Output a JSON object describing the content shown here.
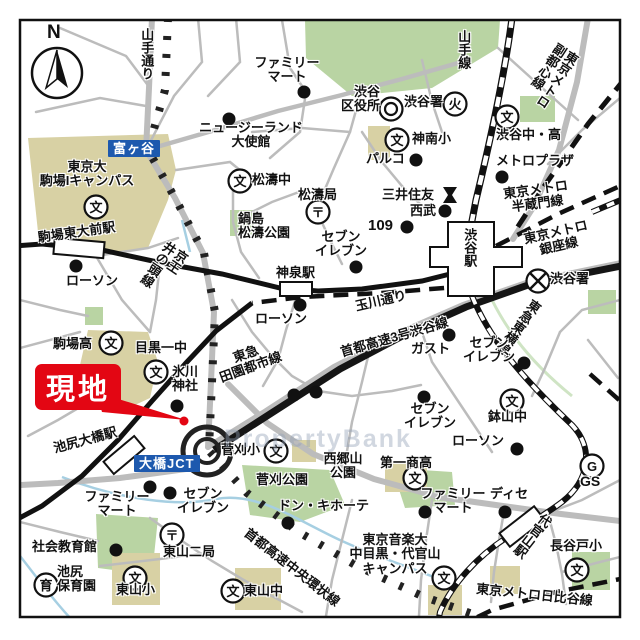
{
  "map": {
    "watermark": "PropertyBank",
    "compass_label": "N",
    "callout": {
      "text": "現地",
      "color": "#e30613"
    },
    "colors": {
      "road": "#bcbcbc",
      "park": "#b9d4a3",
      "campus": "#d8d1a4",
      "water": "#a6cfe2",
      "rail": "#1a1a1a",
      "sign_blue": "#1d59ae",
      "accent_red": "#e30613"
    },
    "signs": [
      {
        "name": "tomigaya-sign",
        "text": "富ヶ谷",
        "x": 108,
        "y": 140
      },
      {
        "name": "ohashi-jct-sign",
        "text": "大橋JCT",
        "x": 134,
        "y": 455
      }
    ],
    "labels": [
      {
        "name": "yamate-dori-label",
        "text": "山手通り",
        "x": 139,
        "y": 28,
        "vert": true
      },
      {
        "name": "yamanote-line-label",
        "text": "山手線",
        "x": 456,
        "y": 30,
        "vert": true
      },
      {
        "name": "fukutoshin-line-label",
        "text": "東京メトロ\n副都心線",
        "x": 556,
        "y": 40,
        "vert": true,
        "rot": 33
      },
      {
        "name": "familymart-top-label",
        "text": "ファミリー\nマート",
        "x": 250,
        "y": 56,
        "w": 74,
        "ctr": true
      },
      {
        "name": "nz-embassy-label",
        "text": "ニュージーランド\n大使館",
        "x": 194,
        "y": 121,
        "w": 114,
        "ctr": true
      },
      {
        "name": "shibuya-ward-office-label",
        "text": "渋谷\n区役所",
        "x": 332,
        "y": 85,
        "w": 48,
        "rgt": true
      },
      {
        "name": "shibuya-fire-station-label",
        "text": "渋谷署",
        "x": 404,
        "y": 95
      },
      {
        "name": "jinnan-elementary-label",
        "text": "神南小",
        "x": 412,
        "y": 132
      },
      {
        "name": "shibuya-jhs-hs-label",
        "text": "渋谷中・高",
        "x": 496,
        "y": 128
      },
      {
        "name": "metro-plaza-label",
        "text": "メトロプラザ",
        "x": 496,
        "y": 154
      },
      {
        "name": "parco-label",
        "text": "パルコ",
        "x": 366,
        "y": 152
      },
      {
        "name": "mitsui-sumitomo-label",
        "text": "三井住友",
        "x": 382,
        "y": 188
      },
      {
        "name": "seibu-label",
        "text": "西武",
        "x": 410,
        "y": 204
      },
      {
        "name": "shibuya-109-label",
        "text": "109",
        "x": 368,
        "y": 218,
        "size": 15
      },
      {
        "name": "shoto-jhs-label",
        "text": "松濤中",
        "x": 252,
        "y": 173
      },
      {
        "name": "shoto-post-label",
        "text": "松濤局",
        "x": 298,
        "y": 188
      },
      {
        "name": "nabeshima-shoto-park-label",
        "text": "鍋島\n松濤公園",
        "x": 238,
        "y": 212,
        "w": 58
      },
      {
        "name": "todai-komaba-campus-label",
        "text": "東京大\n駒場Iキャンパス",
        "x": 34,
        "y": 160,
        "w": 106,
        "ctr": true
      },
      {
        "name": "komaba-todaimae-station-label",
        "text": "駒場東大前駅",
        "x": 37,
        "y": 231,
        "rot": -8
      },
      {
        "name": "keio-inokashira-line-label",
        "text": "京王\n井の頭線",
        "x": 166,
        "y": 238,
        "vert": true,
        "rot": 34
      },
      {
        "name": "lawson-west-label",
        "text": "ローソン",
        "x": 66,
        "y": 274
      },
      {
        "name": "shinsen-station-label",
        "text": "神泉駅",
        "x": 276,
        "y": 266
      },
      {
        "name": "seven-eleven-center-label",
        "text": "セブン\nイレブン",
        "x": 312,
        "y": 230,
        "w": 58,
        "ctr": true
      },
      {
        "name": "lawson-center-label",
        "text": "ローソン",
        "x": 255,
        "y": 312
      },
      {
        "name": "tamagawa-dori-label",
        "text": "玉川通り",
        "x": 354,
        "y": 300,
        "rot": -13
      },
      {
        "name": "shuto-no3-shibuya-line-label",
        "text": "首都高速3号渋谷線",
        "x": 339,
        "y": 346,
        "rot": -16
      },
      {
        "name": "denentoshi-line-label",
        "text": "東急\n田園都市線",
        "x": 204,
        "y": 362,
        "w": 84,
        "ctr": true,
        "rot": -20
      },
      {
        "name": "shibuya-station-label",
        "text": "渋谷駅",
        "x": 462,
        "y": 228,
        "vert": true
      },
      {
        "name": "hanzomon-line-label",
        "text": "東京メトロ\n半蔵門線",
        "x": 499,
        "y": 188,
        "w": 72,
        "ctr": true,
        "rot": -8
      },
      {
        "name": "ginza-line-label",
        "text": "東京メトロ\n銀座線",
        "x": 522,
        "y": 233,
        "w": 66,
        "ctr": true,
        "rot": -13
      },
      {
        "name": "shibuya-police-label",
        "text": "渋谷署",
        "x": 550,
        "y": 272
      },
      {
        "name": "toyoko-line-label",
        "text": "東急東横線",
        "x": 531,
        "y": 296,
        "vert": true,
        "rot": 36
      },
      {
        "name": "gusto-label",
        "text": "ガスト",
        "x": 411,
        "y": 342
      },
      {
        "name": "seven-eleven-east-label",
        "text": "セブン\nイレブン",
        "x": 460,
        "y": 336,
        "w": 58,
        "ctr": true
      },
      {
        "name": "seven-eleven-south-label",
        "text": "セブン\nイレブン",
        "x": 401,
        "y": 402,
        "w": 58,
        "ctr": true
      },
      {
        "name": "hachiyama-jhs-label",
        "text": "鉢山中",
        "x": 488,
        "y": 410
      },
      {
        "name": "lawson-south-label",
        "text": "ローソン",
        "x": 452,
        "y": 434
      },
      {
        "name": "komaba-high-label",
        "text": "駒場高",
        "x": 53,
        "y": 337
      },
      {
        "name": "meguro-1-jhs-label",
        "text": "目黒一中",
        "x": 135,
        "y": 341
      },
      {
        "name": "hikawa-shrine-label",
        "text": "氷川\n神社",
        "x": 164,
        "y": 365,
        "w": 42,
        "ctr": true
      },
      {
        "name": "ikejiri-ohashi-station-label",
        "text": "池尻大橋駅",
        "x": 52,
        "y": 442,
        "rot": -15
      },
      {
        "name": "sugekari-elementary-label",
        "text": "菅刈小",
        "x": 221,
        "y": 443
      },
      {
        "name": "sugekari-park-label",
        "text": "菅刈公園",
        "x": 256,
        "y": 473
      },
      {
        "name": "saigoyama-park-label",
        "text": "西郷山\n公園",
        "x": 316,
        "y": 452,
        "w": 54,
        "ctr": true
      },
      {
        "name": "daiichi-shoko-label",
        "text": "第一商高",
        "x": 380,
        "y": 456
      },
      {
        "name": "familymart-southwest-label",
        "text": "ファミリー\nマート",
        "x": 78,
        "y": 490,
        "w": 78,
        "ctr": true
      },
      {
        "name": "seven-eleven-jct-label",
        "text": "セブン\nイレブン",
        "x": 174,
        "y": 487,
        "w": 58,
        "ctr": true
      },
      {
        "name": "shakai-kyoikukan-label",
        "text": "社会教育館",
        "x": 32,
        "y": 540
      },
      {
        "name": "higashiyama-2-post-label",
        "text": "東山二局",
        "x": 163,
        "y": 545
      },
      {
        "name": "ikejiri-hoikuen-label",
        "text": "池尻\n保育園",
        "x": 57,
        "y": 565
      },
      {
        "name": "higashiyama-elementary-label",
        "text": "東山小",
        "x": 116,
        "y": 583
      },
      {
        "name": "higashiyama-jhs-label",
        "text": "東山中",
        "x": 244,
        "y": 584
      },
      {
        "name": "don-quijote-label",
        "text": "ドン・キホーテ",
        "x": 278,
        "y": 499
      },
      {
        "name": "chuo-kanjo-line-label",
        "text": "首都高速中央環状線",
        "x": 250,
        "y": 526,
        "rot": 38
      },
      {
        "name": "tokyo-ongaku-univ-label",
        "text": "東京音楽大\n中目黒・代官山\nキャンパス",
        "x": 346,
        "y": 533,
        "w": 98,
        "ctr": true
      },
      {
        "name": "familymart-southeast-label",
        "text": "ファミリー\nマート",
        "x": 416,
        "y": 487,
        "w": 74,
        "ctr": true
      },
      {
        "name": "dise-label",
        "text": "ディセ",
        "x": 490,
        "y": 487
      },
      {
        "name": "daikanyama-station-label",
        "text": "代官山駅",
        "x": 542,
        "y": 510,
        "vert": true,
        "rot": 38
      },
      {
        "name": "hasedo-elementary-label",
        "text": "長谷戸小",
        "x": 550,
        "y": 539
      },
      {
        "name": "hibiya-line-label",
        "text": "東京メトロ日比谷線",
        "x": 477,
        "y": 582,
        "rot": 6
      },
      {
        "name": "gas-station-label",
        "text": "GS",
        "x": 580,
        "y": 474,
        "size": 14
      }
    ],
    "symbols": [
      {
        "name": "ward-office-symbol",
        "kind": "gov",
        "x": 391,
        "y": 109,
        "char": ""
      },
      {
        "name": "fire-station-symbol",
        "kind": "char",
        "x": 455,
        "y": 104,
        "char": "火"
      },
      {
        "name": "police-station-symbol",
        "kind": "police",
        "x": 538,
        "y": 281,
        "char": ""
      },
      {
        "name": "post-office-shoto-symbol",
        "kind": "char",
        "x": 318,
        "y": 212,
        "char": "〒"
      },
      {
        "name": "post-office-higashiyama-symbol",
        "kind": "char",
        "x": 172,
        "y": 535,
        "char": "〒"
      },
      {
        "name": "bank-symbol",
        "kind": "bank",
        "x": 450,
        "y": 195,
        "char": ""
      },
      {
        "name": "nursery-symbol",
        "kind": "char",
        "x": 46,
        "y": 585,
        "char": "育"
      },
      {
        "name": "gas-station-symbol",
        "kind": "char",
        "x": 592,
        "y": 466,
        "char": "G"
      },
      {
        "name": "school-symbol-jinnan",
        "kind": "char",
        "x": 397,
        "y": 140,
        "char": "文"
      },
      {
        "name": "school-symbol-shibuya-jhs",
        "kind": "char",
        "x": 507,
        "y": 117,
        "char": "文"
      },
      {
        "name": "school-symbol-shoto",
        "kind": "char",
        "x": 240,
        "y": 181,
        "char": "文"
      },
      {
        "name": "school-symbol-todai",
        "kind": "char",
        "x": 96,
        "y": 207,
        "char": "文"
      },
      {
        "name": "school-symbol-komaba-high",
        "kind": "char",
        "x": 111,
        "y": 343,
        "char": "文"
      },
      {
        "name": "school-symbol-meguro1",
        "kind": "char",
        "x": 156,
        "y": 372,
        "char": "文"
      },
      {
        "name": "school-symbol-sugekari",
        "kind": "char",
        "x": 276,
        "y": 451,
        "char": "文"
      },
      {
        "name": "school-symbol-hachiyama",
        "kind": "char",
        "x": 512,
        "y": 401,
        "char": "文"
      },
      {
        "name": "school-symbol-daiichi",
        "kind": "char",
        "x": 415,
        "y": 478,
        "char": "文"
      },
      {
        "name": "school-symbol-higashiyama-elem",
        "kind": "char",
        "x": 135,
        "y": 578,
        "char": "文"
      },
      {
        "name": "school-symbol-higashiyama-jhs",
        "kind": "char",
        "x": 233,
        "y": 591,
        "char": "文"
      },
      {
        "name": "school-symbol-hasedo",
        "kind": "char",
        "x": 577,
        "y": 570,
        "char": "文"
      },
      {
        "name": "school-symbol-ongakudai",
        "kind": "char",
        "x": 444,
        "y": 578,
        "char": "文"
      }
    ],
    "poi_dots": [
      [
        304,
        92
      ],
      [
        229,
        119
      ],
      [
        416,
        160
      ],
      [
        502,
        177
      ],
      [
        445,
        211
      ],
      [
        407,
        227
      ],
      [
        356,
        267
      ],
      [
        300,
        305
      ],
      [
        76,
        266
      ],
      [
        294,
        395
      ],
      [
        316,
        392
      ],
      [
        449,
        335
      ],
      [
        524,
        363
      ],
      [
        424,
        397
      ],
      [
        517,
        449
      ],
      [
        177,
        406
      ],
      [
        150,
        487
      ],
      [
        170,
        493
      ],
      [
        116,
        550
      ],
      [
        288,
        523
      ],
      [
        425,
        512
      ],
      [
        505,
        512
      ]
    ],
    "stations": [
      {
        "name": "komaba-todaimae-station",
        "x": 54,
        "y": 240,
        "w": 50,
        "h": 16,
        "rot": 5
      },
      {
        "name": "shinsen-station",
        "x": 280,
        "y": 282,
        "w": 32,
        "h": 14,
        "rot": 0
      },
      {
        "name": "daikanyama-station",
        "x": 500,
        "y": 518,
        "w": 44,
        "h": 17,
        "rot": -38
      },
      {
        "name": "ikejiri-ohashi-station",
        "x": 104,
        "y": 447,
        "w": 40,
        "h": 16,
        "rot": -40
      }
    ]
  }
}
